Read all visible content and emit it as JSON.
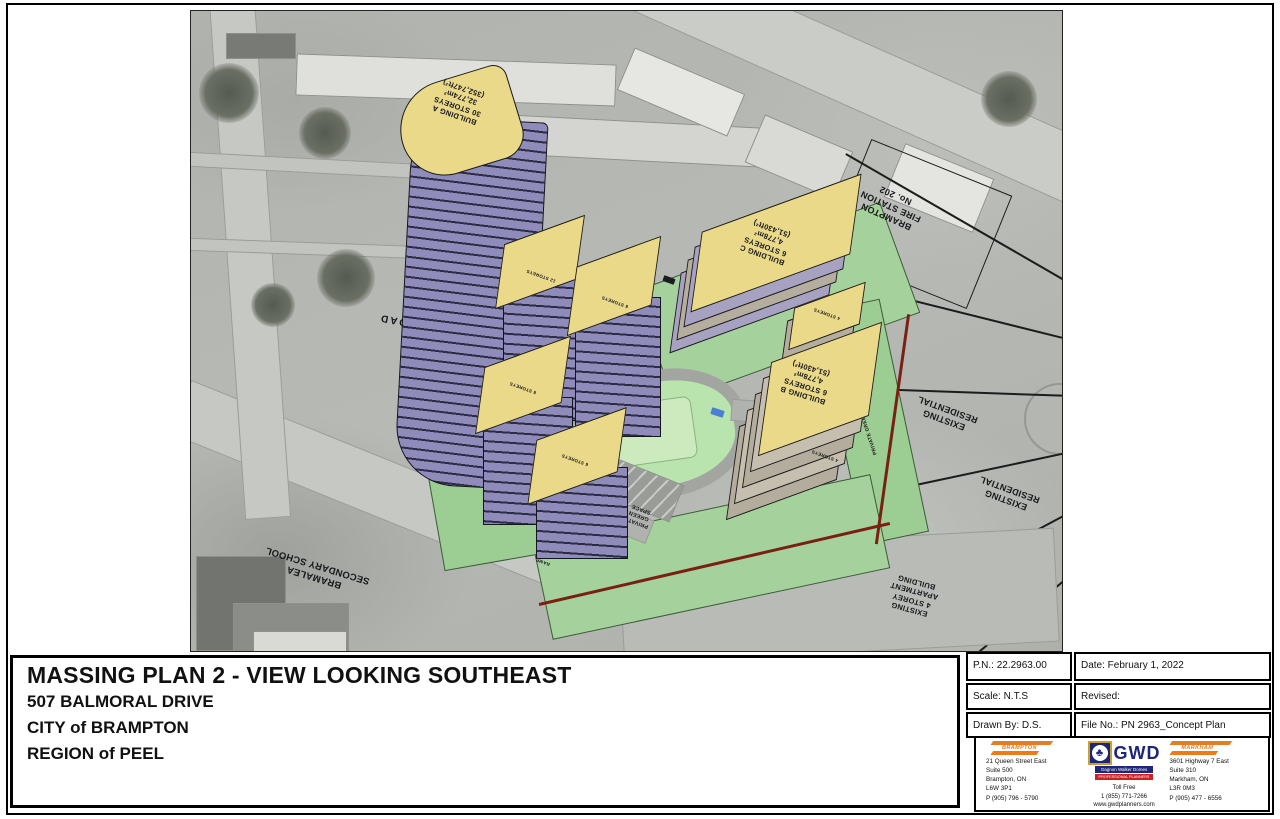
{
  "sheet": {
    "title_block": {
      "title": "MASSING PLAN 2 - VIEW LOOKING SOUTHEAST",
      "address": "507 BALMORAL DRIVE",
      "city": "CITY of BRAMPTON",
      "region": "REGION of PEEL"
    },
    "info_table": {
      "pn": "P.N.: 22.2963.00",
      "date": "Date: February 1, 2022",
      "scale": "Scale: N.T.S",
      "revised": "Revised:",
      "drawn_by": "Drawn By: D.S.",
      "file_no": "File No.: PN 2963_Concept Plan"
    },
    "consultant": {
      "brampton_office": {
        "logo": "BRAMPTON",
        "address": "21 Queen Street East\nSuite 500\nBrampton, ON\nL6W 3P1\nP (905) 796 - 5790"
      },
      "gwd": {
        "name": "GWD",
        "subtitle": "Gagnon Walker Domes",
        "tagline": "PROFESSIONAL PLANNERS",
        "emblem_icon": "♣",
        "contact": "Toll Free\n1 (855) 771-7266\nwww.gwdplanners.com",
        "colors": {
          "navy": "#1e2678",
          "gold": "#c8a22a",
          "red": "#cc2027",
          "orange": "#e87c1e"
        }
      },
      "markham_office": {
        "logo": "MARKHAM",
        "address": "3601 Highway 7 East\nSuite 310\nMarkham, ON\nL3R 0M3\nP (905) 477 - 6556"
      }
    },
    "plan": {
      "buildings": {
        "a": "BUILDING A\n30 STOREYS\n32,774m²\n(352,747ft²)",
        "b": "BUILDING B\n6 STOREYS\n4,778m²\n(51,430ft²)",
        "c": "BUILDING C\n6 STOREYS\n4,778m²\n(51,430ft²)",
        "storeys": [
          "12 STOREYS",
          "8 STOREYS",
          "8 STOREYS",
          "6 STOREYS",
          "4 STOREYS",
          "4 STOREYS"
        ]
      },
      "context_labels": {
        "balmoral_drive": "BALMORAL DRIVE",
        "bramalea_road": "BRAMALEA ROAD",
        "school": "BRAMALEA\nSECONDARY SCHOOL",
        "fire_station": "BRAMPTON\nFIRE STATION\nNo. 202",
        "existing_residential": "EXISTING\nRESIDENTIAL",
        "existing_apartment": "EXISTING\n4 STOREY\nAPARTMENT\nBUILDING",
        "private_green_space": "PRIVATE\nGREEN\nSPACE",
        "private_green_space_strip": "PRIVATE GREEN SPACE",
        "ramp": "RAMP",
        "private_road": "PRIVATE ROAD"
      },
      "colors": {
        "massing_yellow": "#e9d989",
        "massing_purple": "#8f8cbb",
        "site_green": "#a5d29c",
        "boundary_red": "#7a2013"
      }
    }
  }
}
